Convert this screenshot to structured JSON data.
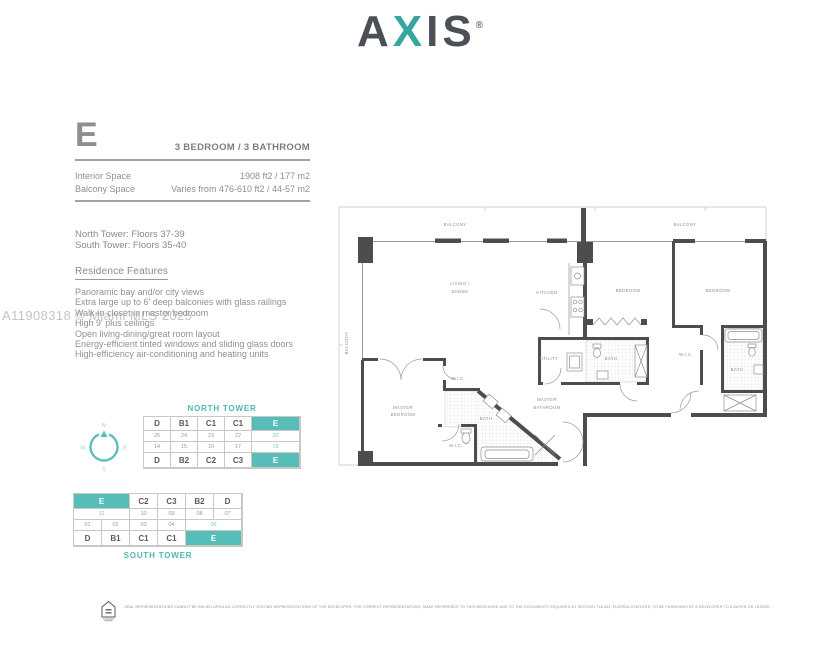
{
  "brand": {
    "a": "A",
    "x": "X",
    "is": "IS",
    "registered": "®"
  },
  "unit": {
    "letter": "E",
    "type": "3 BEDROOM / 3 BATHROOM"
  },
  "specs": {
    "rows": [
      {
        "label": "Interior Space",
        "value": "1908 ft2 / 177 m2"
      },
      {
        "label": "Balcony Space",
        "value": "Varies from 476-610 ft2 / 44-57 m2"
      }
    ]
  },
  "towers": {
    "north": "North Tower: Floors 37-39",
    "south": "South Tower: Floors 35-40"
  },
  "features": {
    "heading": "Residence Features",
    "items": [
      "Panoramic bay and/or city views",
      "Extra large up to 6' deep balconies with glass railings",
      "Walk-in closet in master bedroom",
      "High 9' plus ceilings",
      "Open living-dining/great room layout",
      "Energy-efficient tinted windows and sliding glass doors",
      "High-efficiency air-conditioning and heating units"
    ]
  },
  "watermark": "A11908318 © Miami MLS 2025",
  "compass": {
    "n": "N",
    "e": "E",
    "s": "S",
    "w": "W"
  },
  "north_tower": {
    "title": "NORTH TOWER",
    "rows": [
      [
        "D",
        "B1",
        "C1",
        "C1",
        "E"
      ],
      [
        "25",
        "24",
        "23",
        "22",
        "20"
      ],
      [
        "14",
        "15",
        "16",
        "17",
        "19"
      ],
      [
        "D",
        "B2",
        "C2",
        "C3",
        "E"
      ]
    ]
  },
  "south_tower": {
    "title": "SOUTH TOWER",
    "rows": [
      [
        "E",
        "C2",
        "C3",
        "B2",
        "D"
      ],
      [
        "12",
        "10",
        "09",
        "08",
        "07"
      ],
      [
        "01",
        "02",
        "03",
        "04",
        "06"
      ],
      [
        "D",
        "B1",
        "C1",
        "C1",
        "E"
      ]
    ]
  },
  "floorplan": {
    "labels": {
      "balcony": "BALCONY",
      "living_line1": "LIVING /",
      "living_line2": "DINING",
      "kitchen": "KITCHEN",
      "utility": "UTILITY",
      "bath": "BATH",
      "wic": "W.I.C.",
      "bedroom": "BEDROOM",
      "master": "MASTER",
      "bathroom": "BATHROOM"
    }
  },
  "footer": {
    "disclaimer": "ORAL REPRESENTATIONS CANNOT BE RELIED UPON AS CORRECTLY STATING REPRESENTATIONS OF THE DEVELOPER.  FOR CORRECT REPRESENTATIONS, MAKE REFERENCE TO THIS BROCHURE AND TO THE DOCUMENTS REQUIRED BY SECTION 718.503, FLORIDA STATUTES, TO BE FURNISHED BY A DEVELOPER TO A BUYER OR LESSEE."
  },
  "colors": {
    "teal": "#4fb5b0",
    "logo_teal": "#3aa59e",
    "text_gray": "#8a8a8a",
    "wall": "#4d4d4d"
  }
}
